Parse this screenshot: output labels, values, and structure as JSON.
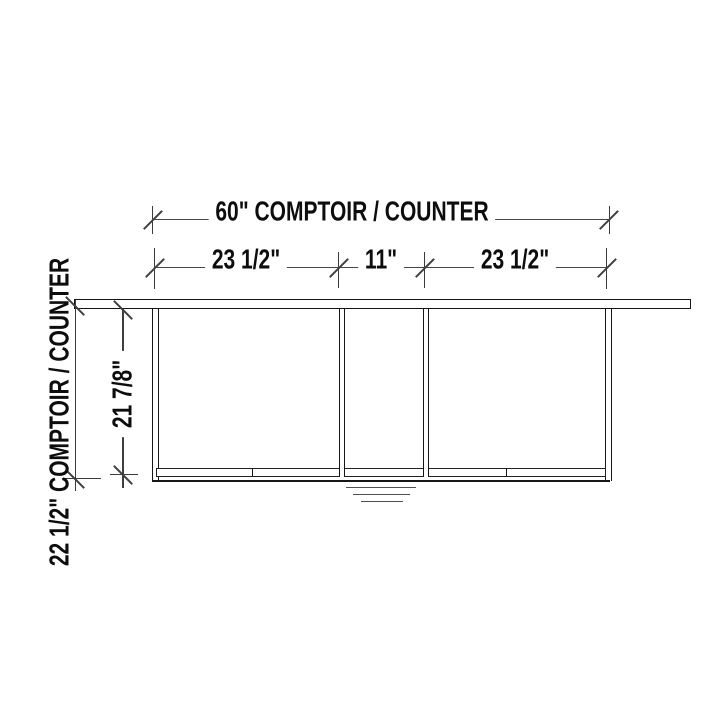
{
  "drawing_title": "Counter / cabinet front elevation",
  "dimensions": {
    "top_total": "60\" COMPTOIR / COUNTER",
    "row2_left": "23 1/2\"",
    "row2_middle": "11\"",
    "row2_right": "23 1/2\"",
    "left_overall": "22 1/2\" COMPTOIR / COUNTER",
    "left_cabinet_height": "21 7/8\""
  },
  "colors": {
    "background": "#ffffff",
    "object_line": "#161616",
    "dimension_line": "#474747",
    "text": "#0d0d0d"
  }
}
